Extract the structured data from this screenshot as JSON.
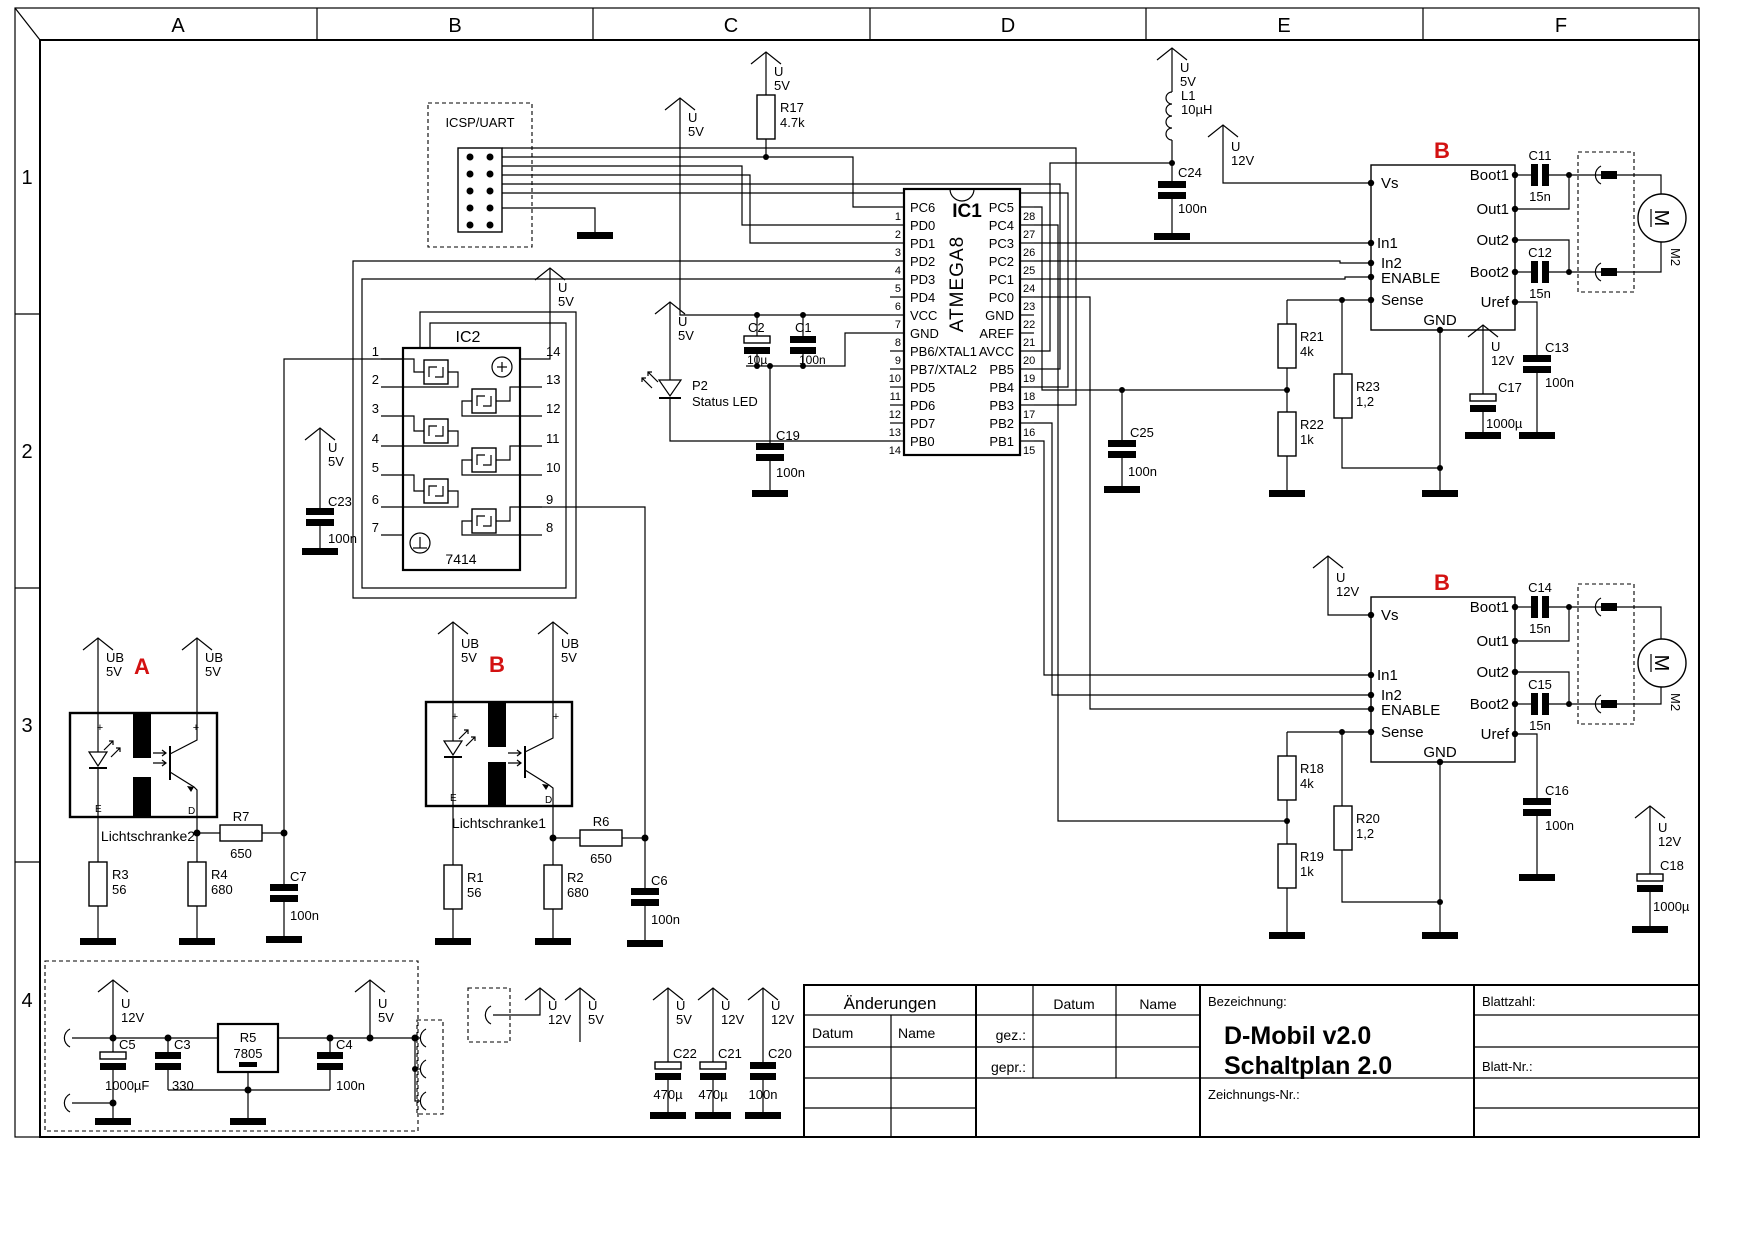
{
  "frame": {
    "cols": [
      "A",
      "B",
      "C",
      "D",
      "E",
      "F"
    ],
    "rows": [
      "1",
      "2",
      "3",
      "4"
    ]
  },
  "labels": {
    "u": "U",
    "v5": "5V",
    "v12": "12V",
    "ub": "UB"
  },
  "icsp": {
    "title": "ICSP/UART"
  },
  "ic1": {
    "ref": "IC1",
    "part": "ATMEGA8",
    "left": [
      {
        "n": "1",
        "label": "PC6"
      },
      {
        "n": "2",
        "label": "PD0"
      },
      {
        "n": "3",
        "label": "PD1"
      },
      {
        "n": "4",
        "label": "PD2"
      },
      {
        "n": "5",
        "label": "PD3"
      },
      {
        "n": "6",
        "label": "PD4"
      },
      {
        "n": "7",
        "label": "VCC"
      },
      {
        "n": "8",
        "label": "GND"
      },
      {
        "n": "9",
        "label": "PB6/XTAL1"
      },
      {
        "n": "10",
        "label": "PB7/XTAL2"
      },
      {
        "n": "11",
        "label": "PD5"
      },
      {
        "n": "12",
        "label": "PD6"
      },
      {
        "n": "13",
        "label": "PD7"
      },
      {
        "n": "14",
        "label": "PB0"
      }
    ],
    "right": [
      {
        "n": "28",
        "label": "PC5"
      },
      {
        "n": "27",
        "label": "PC4"
      },
      {
        "n": "26",
        "label": "PC3"
      },
      {
        "n": "25",
        "label": "PC2"
      },
      {
        "n": "24",
        "label": "PC1"
      },
      {
        "n": "23",
        "label": "PC0"
      },
      {
        "n": "22",
        "label": "GND"
      },
      {
        "n": "21",
        "label": "AREF"
      },
      {
        "n": "20",
        "label": "AVCC"
      },
      {
        "n": "19",
        "label": "PB5"
      },
      {
        "n": "18",
        "label": "PB4"
      },
      {
        "n": "17",
        "label": "PB3"
      },
      {
        "n": "16",
        "label": "PB2"
      },
      {
        "n": "15",
        "label": "PB1"
      }
    ]
  },
  "ic2": {
    "ref": "IC2",
    "part": "7414",
    "left_nums": [
      "1",
      "2",
      "3",
      "4",
      "5",
      "6",
      "7"
    ],
    "right_nums": [
      "14",
      "13",
      "12",
      "11",
      "10",
      "9",
      "8"
    ]
  },
  "drv": {
    "tag": "B",
    "left": [
      "Vs",
      "In1",
      "In2",
      "ENABLE",
      "Sense"
    ],
    "right": [
      "Boot1",
      "Out1",
      "Out2",
      "Boot2",
      "Uref"
    ],
    "gnd": "GND"
  },
  "motor": {
    "m": "M",
    "ref": "M2"
  },
  "ls": {
    "a_tag": "A",
    "b_tag": "B",
    "a_name": "Lichtschranke2",
    "b_name": "Lichtschranke1",
    "e": "E",
    "d": "D",
    "plus": "+"
  },
  "parts": {
    "r17": {
      "r": "R17",
      "v": "4.7k"
    },
    "r21": {
      "r": "R21",
      "v": "4k"
    },
    "r22": {
      "r": "R22",
      "v": "1k"
    },
    "r23": {
      "r": "R23",
      "v": "1,2"
    },
    "r18": {
      "r": "R18",
      "v": "4k"
    },
    "r19": {
      "r": "R19",
      "v": "1k"
    },
    "r20": {
      "r": "R20",
      "v": "1,2"
    },
    "r1": {
      "r": "R1",
      "v": "56"
    },
    "r2": {
      "r": "R2",
      "v": "680"
    },
    "r3": {
      "r": "R3",
      "v": "56"
    },
    "r4": {
      "r": "R4",
      "v": "680"
    },
    "r5": {
      "r": "R5",
      "v": "7805"
    },
    "r6": {
      "r": "R6",
      "v": "650"
    },
    "r7": {
      "r": "R7",
      "v": "650"
    },
    "c1": {
      "r": "C1",
      "v": "100n"
    },
    "c2": {
      "r": "C2",
      "v": "10µ"
    },
    "c3": {
      "r": "C3",
      "v": "330"
    },
    "c4": {
      "r": "C4",
      "v": "100n"
    },
    "c5": {
      "r": "C5",
      "v": "1000µF"
    },
    "c6": {
      "r": "C6",
      "v": "100n"
    },
    "c7": {
      "r": "C7",
      "v": "100n"
    },
    "c11": {
      "r": "C11",
      "v": "15n"
    },
    "c12": {
      "r": "C12",
      "v": "15n"
    },
    "c13": {
      "r": "C13",
      "v": "100n"
    },
    "c14": {
      "r": "C14",
      "v": "15n"
    },
    "c15": {
      "r": "C15",
      "v": "15n"
    },
    "c16": {
      "r": "C16",
      "v": "100n"
    },
    "c17": {
      "r": "C17",
      "v": "1000µ"
    },
    "c18": {
      "r": "C18",
      "v": "1000µ"
    },
    "c19": {
      "r": "C19",
      "v": "100n"
    },
    "c20": {
      "r": "C20",
      "v": "100n"
    },
    "c21": {
      "r": "C21",
      "v": "470µ"
    },
    "c22": {
      "r": "C22",
      "v": "470µ"
    },
    "c23": {
      "r": "C23",
      "v": "100n"
    },
    "c24": {
      "r": "C24",
      "v": "100n"
    },
    "c25": {
      "r": "C25",
      "v": "100n"
    },
    "l1": {
      "r": "L1",
      "v": "10µH"
    },
    "p2": {
      "r": "P2",
      "v": "Status LED"
    }
  },
  "tb": {
    "aenderungen": "Änderungen",
    "datum": "Datum",
    "name": "Name",
    "gez": "gez.:",
    "gepr": "gepr.:",
    "bezeichnung": "Bezeichnung:",
    "title1": "D-Mobil v2.0",
    "title2": "Schaltplan 2.0",
    "zeichnung": "Zeichnungs-Nr.:",
    "blattzahl": "Blattzahl:",
    "blattnr": "Blatt-Nr.:"
  }
}
